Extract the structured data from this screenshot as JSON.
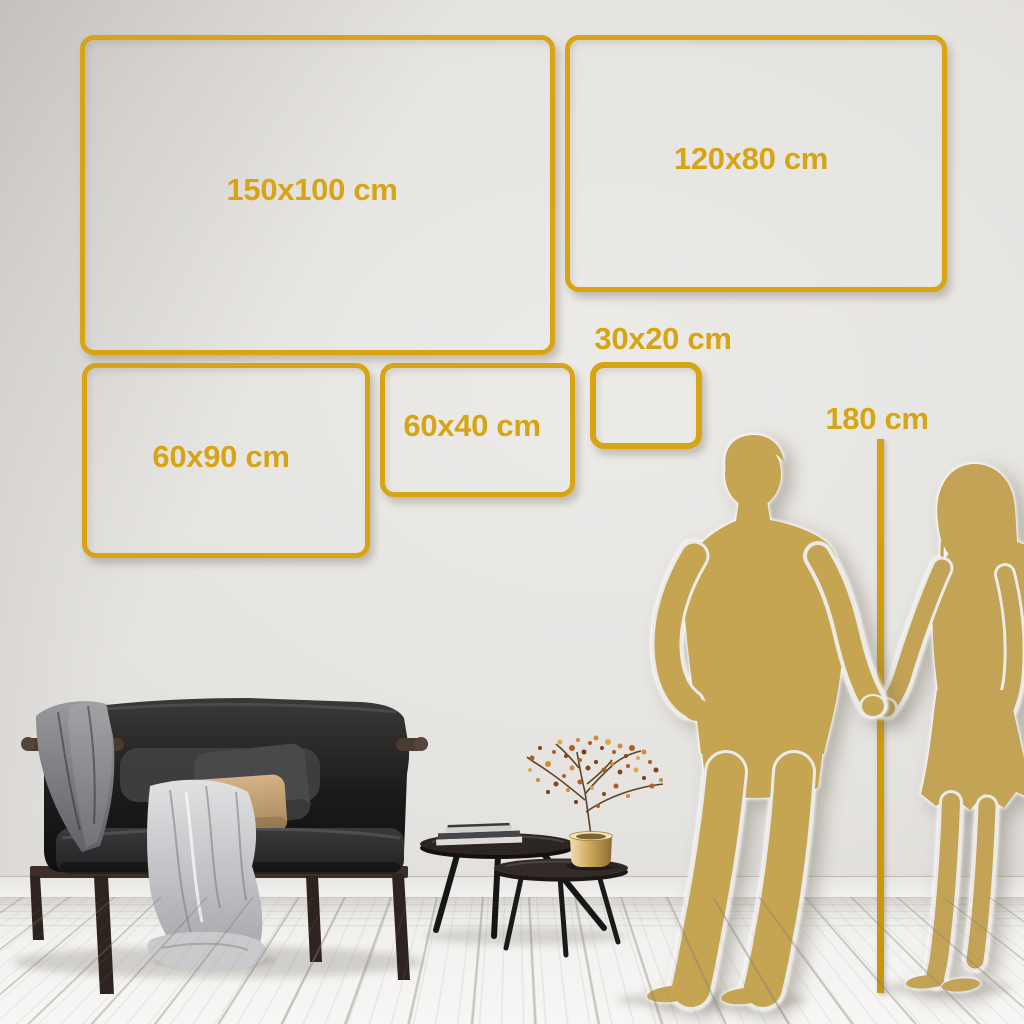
{
  "size_guide": {
    "frame_sizes": [
      {
        "label": "150x100 cm",
        "width_cm": 150,
        "height_cm": 100
      },
      {
        "label": "120x80 cm",
        "width_cm": 120,
        "height_cm": 80
      },
      {
        "label": "60x90 cm",
        "width_cm": 60,
        "height_cm": 90
      },
      {
        "label": "60x40 cm",
        "width_cm": 60,
        "height_cm": 40
      },
      {
        "label": "30x20 cm",
        "width_cm": 30,
        "height_cm": 20
      }
    ],
    "height_marker": {
      "label": "180 cm",
      "height_cm": 180
    }
  },
  "colors": {
    "accent_gold": "#d7a413",
    "silhouette_gold": "#c3a355",
    "ruler_gold": "#cf9d0e",
    "wall": "#e4e2df",
    "floor": "#f2f1ef"
  },
  "scene": {
    "elements": [
      "sofa",
      "blankets",
      "cushions",
      "nesting-coffee-tables",
      "books",
      "brass-vase-with-dried-flowers",
      "man-silhouette",
      "woman-silhouette",
      "height-ruler-line"
    ]
  }
}
